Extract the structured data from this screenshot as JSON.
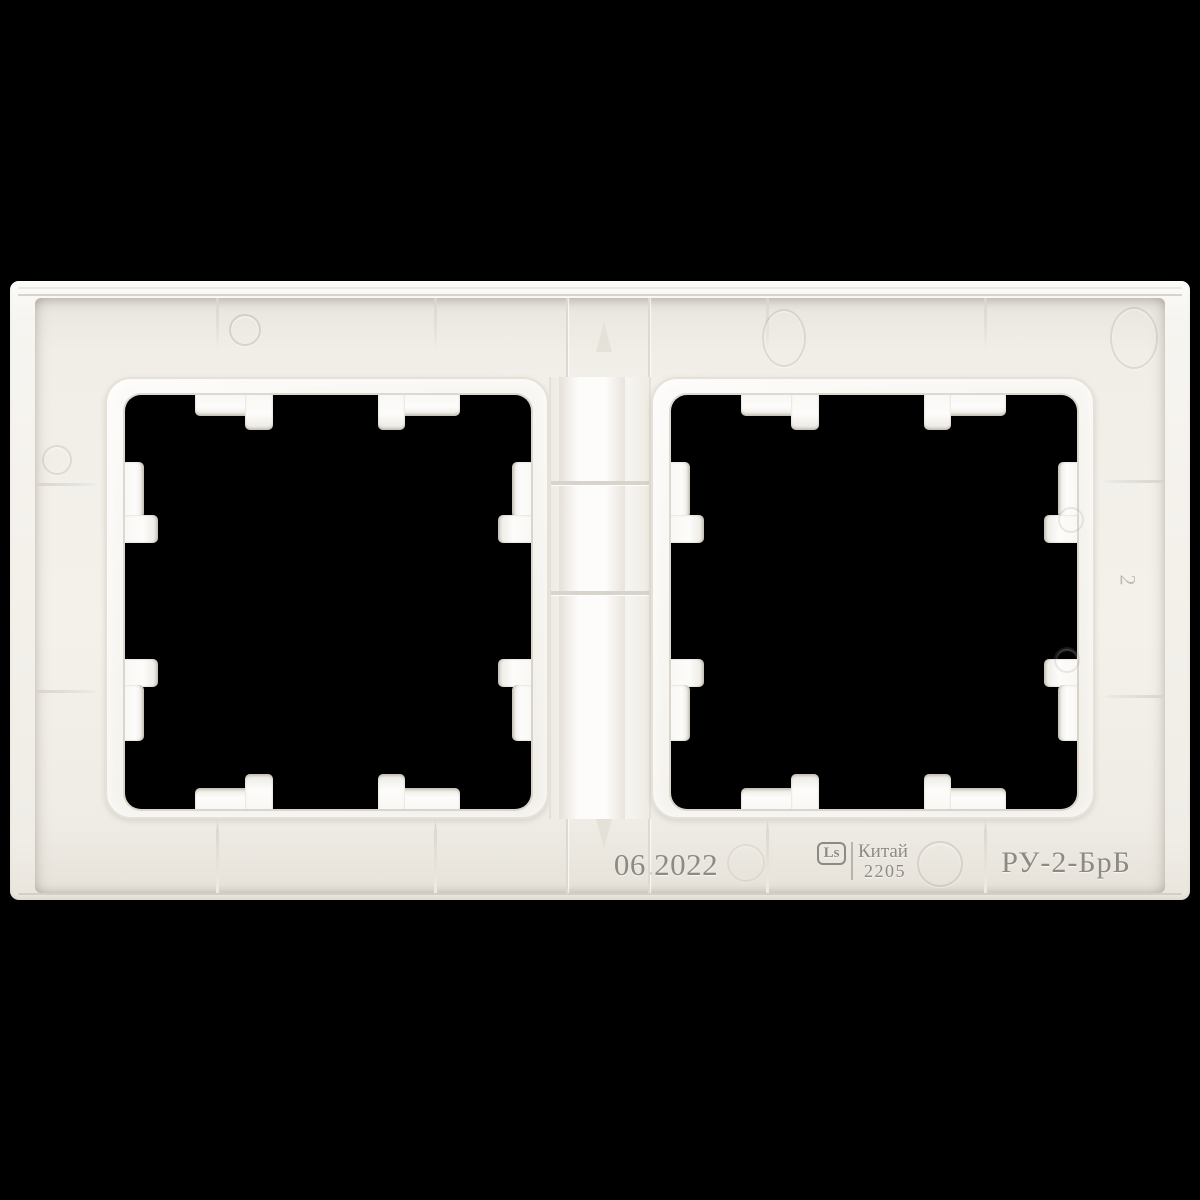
{
  "scene": {
    "type": "product-photo",
    "subject": "Rear view of a white plastic two-gang wall plate frame on a black background",
    "background_color": "#000000",
    "plastic_color": "#f5f2ec",
    "cavity_shadow_color": "#e6e2da",
    "emboss_text_color": "#8d8a84"
  },
  "markings": {
    "date_stamp": "06.2022",
    "logo": "Ls",
    "country": "Китай",
    "batch_code": "2205",
    "model_code": "РУ-2-БрБ",
    "mold_cavity_number": "2"
  }
}
